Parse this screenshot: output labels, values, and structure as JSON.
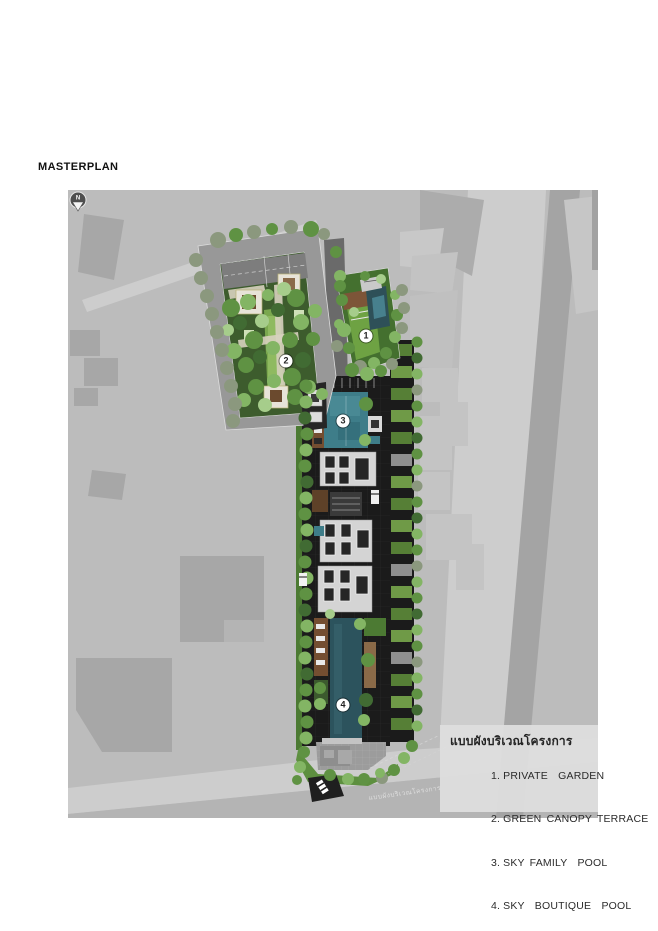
{
  "page": {
    "title": "MASTERPLAN"
  },
  "plan": {
    "north": {
      "label": "N"
    },
    "watermark": "แบบผังบริเวณโครงการ",
    "markers": [
      {
        "label": "1"
      },
      {
        "label": "2"
      },
      {
        "label": "3"
      },
      {
        "label": "4"
      }
    ],
    "legend": {
      "heading": "แบบผังบริเวณโครงการ",
      "items": [
        {
          "num": "1.",
          "label": "PRIVATE  GARDEN"
        },
        {
          "num": "2.",
          "label": "GREEN CANOPY TERRACE"
        },
        {
          "num": "3.",
          "label": "SKY FAMILY  POOL"
        },
        {
          "num": "4.",
          "label": "SKY  BOUTIQUE  POOL"
        }
      ]
    },
    "colors": {
      "plan_bg": "#bcbcbc",
      "building_footprint": "#a7a7a7",
      "road_light": "#cdcdcd",
      "site_green_dark": "#3d5c2d",
      "lawn_green": "#6ea243",
      "tree_green": "#5f9243",
      "roof_dark": "#1b1b1b",
      "pool_family": "#3e7d89",
      "pool_boutique": "#2c535d",
      "deck_brown": "#744e31",
      "legend_bg": "#dedede",
      "marker_bg": "#ffffff",
      "marker_text": "#222222"
    }
  }
}
